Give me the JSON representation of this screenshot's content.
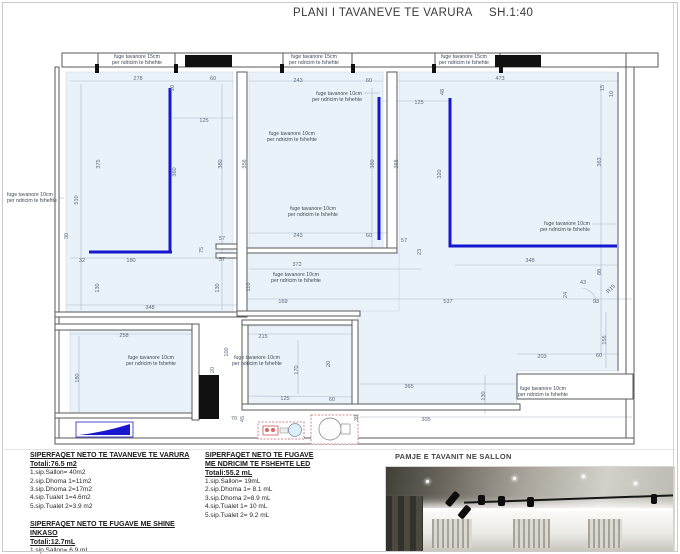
{
  "title": {
    "main": "PLANI I TAVANEVE TE VARURA",
    "scale": "SH.1:40"
  },
  "plan": {
    "colors": {
      "led_blue": "#1717cf",
      "room_fill": "#eaf2f9",
      "wall_gray": "#5a5a5a"
    },
    "labels": {
      "l15": [
        "fuge tavanore 15cm",
        "per ndricim te fshehte"
      ],
      "l10": [
        "fuge tavanore 10cm",
        "per ndricim te fshehte"
      ]
    },
    "annotations": [
      {
        "k": "l15",
        "x": 137,
        "y": 58,
        "a": "middle"
      },
      {
        "k": "l15",
        "x": 314,
        "y": 58,
        "a": "middle"
      },
      {
        "k": "l15",
        "x": 464,
        "y": 58,
        "a": "middle"
      },
      {
        "k": "l10",
        "x": 7,
        "y": 196,
        "a": "start"
      },
      {
        "k": "l10",
        "x": 362,
        "y": 95,
        "a": "end"
      },
      {
        "k": "l10",
        "x": 292,
        "y": 135,
        "a": "middle"
      },
      {
        "k": "l10",
        "x": 313,
        "y": 210,
        "a": "middle"
      },
      {
        "k": "l10",
        "x": 296,
        "y": 276,
        "a": "middle"
      },
      {
        "k": "l10",
        "x": 590,
        "y": 225,
        "a": "end"
      },
      {
        "k": "l10",
        "x": 151,
        "y": 359,
        "a": "middle"
      },
      {
        "k": "l10",
        "x": 257,
        "y": 359,
        "a": "middle"
      },
      {
        "k": "l10",
        "x": 543,
        "y": 390,
        "a": "middle"
      }
    ],
    "dimensions": [
      {
        "t": "278",
        "x": 138,
        "y": 80
      },
      {
        "t": "20",
        "x": 174,
        "y": 88,
        "r": 1
      },
      {
        "t": "60",
        "x": 213,
        "y": 80
      },
      {
        "t": "125",
        "x": 204,
        "y": 122
      },
      {
        "t": "375",
        "x": 100,
        "y": 164,
        "r": 1
      },
      {
        "t": "360",
        "x": 176,
        "y": 172,
        "r": 1
      },
      {
        "t": "380",
        "x": 222,
        "y": 164,
        "r": 1
      },
      {
        "t": "510",
        "x": 78,
        "y": 200,
        "r": 1
      },
      {
        "t": "30",
        "x": 68,
        "y": 236,
        "r": 1
      },
      {
        "t": "32",
        "x": 82,
        "y": 262
      },
      {
        "t": "180",
        "x": 131,
        "y": 262
      },
      {
        "t": "130",
        "x": 99,
        "y": 288,
        "r": 1
      },
      {
        "t": "130",
        "x": 219,
        "y": 288,
        "r": 1
      },
      {
        "t": "348",
        "x": 150,
        "y": 309
      },
      {
        "t": "57",
        "x": 222,
        "y": 240
      },
      {
        "t": "75",
        "x": 203,
        "y": 250,
        "r": 1
      },
      {
        "t": "57",
        "x": 222,
        "y": 261
      },
      {
        "t": "243",
        "x": 298,
        "y": 82
      },
      {
        "t": "60",
        "x": 369,
        "y": 82
      },
      {
        "t": "356",
        "x": 246,
        "y": 164,
        "r": 1
      },
      {
        "t": "380",
        "x": 374,
        "y": 164,
        "r": 1
      },
      {
        "t": "368",
        "x": 398,
        "y": 164,
        "r": 1
      },
      {
        "t": "48",
        "x": 444,
        "y": 92,
        "r": 1
      },
      {
        "t": "125",
        "x": 419,
        "y": 104
      },
      {
        "t": "320",
        "x": 441,
        "y": 174,
        "r": 1
      },
      {
        "t": "473",
        "x": 500,
        "y": 80
      },
      {
        "t": "363",
        "x": 601,
        "y": 162,
        "r": 1
      },
      {
        "t": "15",
        "x": 604,
        "y": 88,
        "r": 1
      },
      {
        "t": "10",
        "x": 613,
        "y": 94,
        "r": 1
      },
      {
        "t": "243",
        "x": 298,
        "y": 237
      },
      {
        "t": "60",
        "x": 369,
        "y": 237
      },
      {
        "t": "57",
        "x": 404,
        "y": 242
      },
      {
        "t": "23",
        "x": 421,
        "y": 252,
        "r": 1
      },
      {
        "t": "348",
        "x": 530,
        "y": 262
      },
      {
        "t": "372",
        "x": 297,
        "y": 266
      },
      {
        "t": "110",
        "x": 250,
        "y": 287,
        "r": 1
      },
      {
        "t": "169",
        "x": 283,
        "y": 303
      },
      {
        "t": "537",
        "x": 448,
        "y": 303
      },
      {
        "t": "88",
        "x": 601,
        "y": 272,
        "r": 1
      },
      {
        "t": "43",
        "x": 583,
        "y": 284
      },
      {
        "t": "24",
        "x": 567,
        "y": 295,
        "r": 1
      },
      {
        "t": "R15",
        "x": 612,
        "y": 290,
        "r": 2
      },
      {
        "t": "93",
        "x": 596,
        "y": 303
      },
      {
        "t": "258",
        "x": 124,
        "y": 337
      },
      {
        "t": "180",
        "x": 79,
        "y": 378,
        "r": 1
      },
      {
        "t": "100",
        "x": 228,
        "y": 352,
        "r": 1
      },
      {
        "t": "20",
        "x": 214,
        "y": 370,
        "r": 1
      },
      {
        "t": "215",
        "x": 263,
        "y": 338
      },
      {
        "t": "20",
        "x": 330,
        "y": 364,
        "r": 1
      },
      {
        "t": "170",
        "x": 298,
        "y": 370,
        "r": 1
      },
      {
        "t": "125",
        "x": 285,
        "y": 400
      },
      {
        "t": "60",
        "x": 332,
        "y": 401
      },
      {
        "t": "45",
        "x": 244,
        "y": 419,
        "r": 1
      },
      {
        "t": "70",
        "x": 234,
        "y": 420
      },
      {
        "t": "39",
        "x": 358,
        "y": 418,
        "r": 1
      },
      {
        "t": "365",
        "x": 409,
        "y": 388
      },
      {
        "t": "305",
        "x": 426,
        "y": 421
      },
      {
        "t": "203",
        "x": 542,
        "y": 358
      },
      {
        "t": "60",
        "x": 599,
        "y": 357
      },
      {
        "t": "155",
        "x": 606,
        "y": 340,
        "r": 1
      },
      {
        "t": "130",
        "x": 485,
        "y": 396,
        "r": 1
      }
    ]
  },
  "legend": {
    "block1": {
      "heading": [
        "SIPERFAQET NETO TE TAVANEVE TE VARURA"
      ],
      "total": "Totali:76.5 m2",
      "items": [
        "1.sip.Sallon= 40m2",
        "2.sip.Dhoma 1=11m2",
        "3.sip.Dhoma 2=17m2",
        "4.sip.Tualet 1=4.6m2",
        "5.sip.Tualet 2=3.9 m2"
      ]
    },
    "block2": {
      "heading": [
        "SIPERFAQET NETO TE FUGAVE ME SHINE INKASO"
      ],
      "total": "Totali:12.7mL",
      "items": [
        "1.sip.Sallon= 6.9 mL",
        "2.sip.Dhoma 2=5.8mL"
      ]
    },
    "block3": {
      "heading": [
        "SIPERFAQET NETO TE FUGAVE",
        "ME NDRICIM TE FSHEHTE LED"
      ],
      "total": "Totali:55.2 mL",
      "items": [
        "1.sip.Sallon= 19mL",
        "2.sip.Dhoma 1= 8.1 mL",
        "3.sip.Dhoma 2=8.9 mL",
        "4.sip.Tualet 1= 10 mL",
        "5.sip.Tualet 2= 9.2 mL"
      ]
    }
  },
  "photo": {
    "caption": "PAMJE E TAVANIT NE SALLON"
  }
}
